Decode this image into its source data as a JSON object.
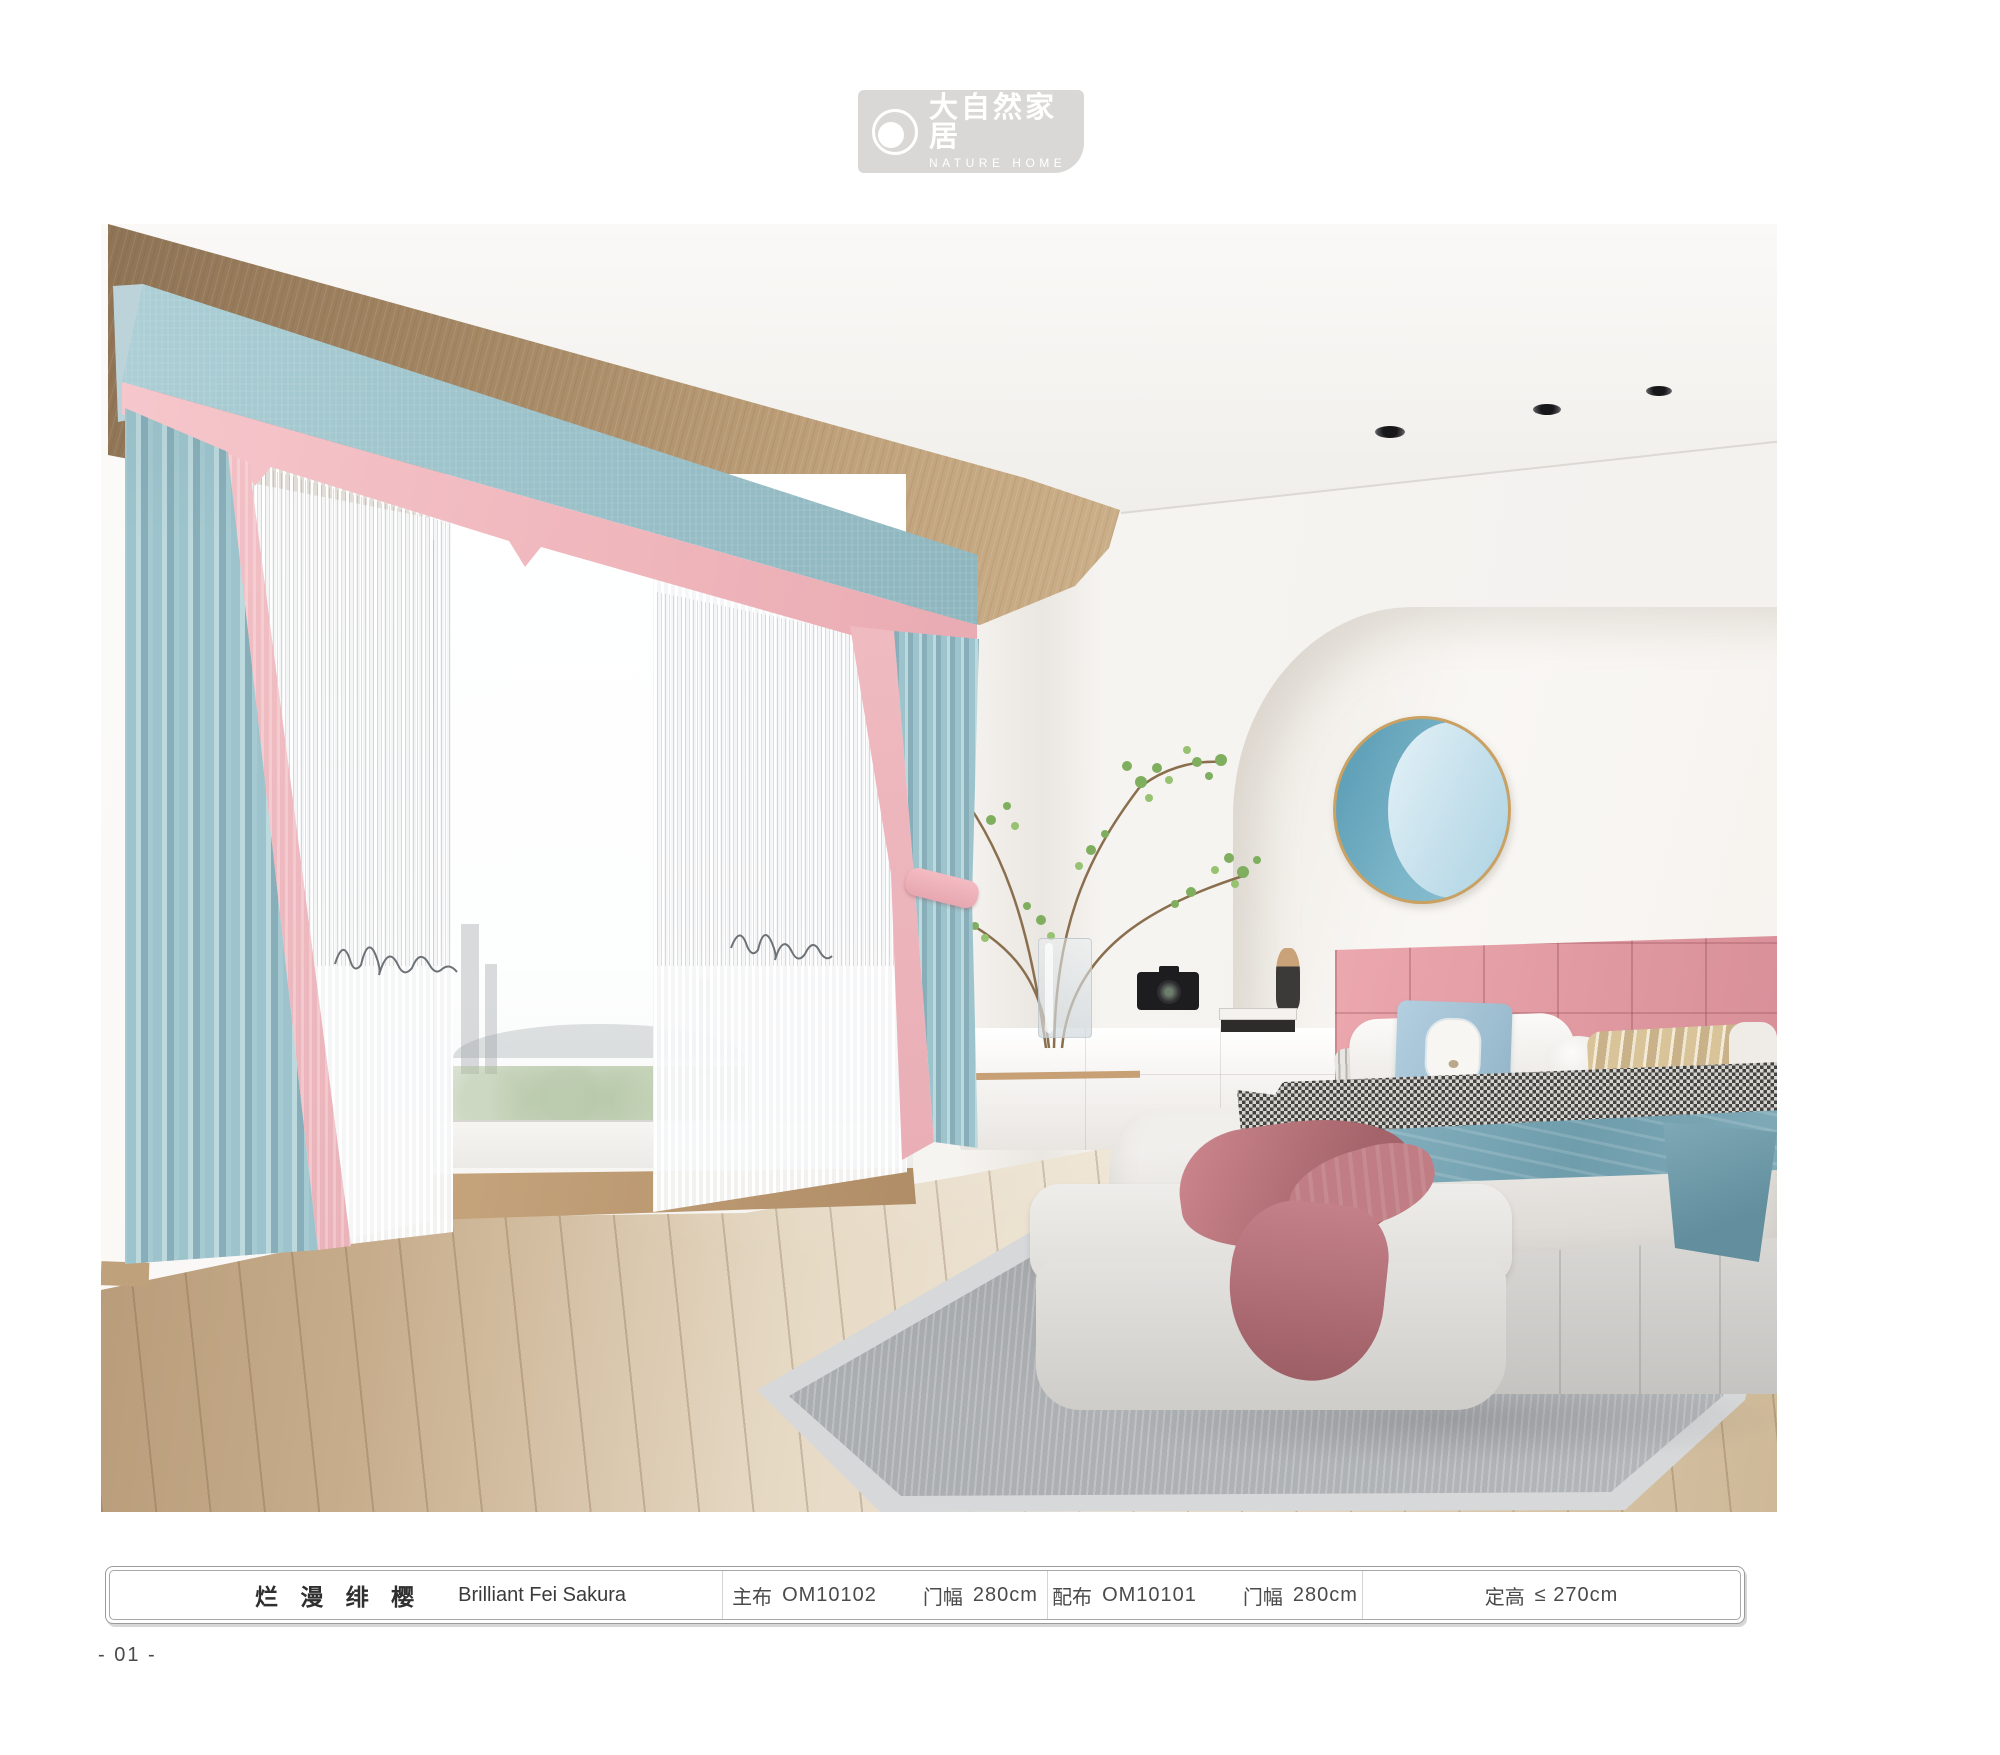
{
  "brand": {
    "name_cn": "大自然家居",
    "name_en": "NATURE HOME"
  },
  "product": {
    "name_cn": "烂 漫 绯 樱",
    "name_en": "Brilliant Fei Sakura",
    "main_fabric": {
      "label": "主布",
      "code": "OM10102",
      "width_label": "门幅",
      "width": "280cm"
    },
    "companion_fabric": {
      "label": "配布",
      "code": "OM10101",
      "width_label": "门幅",
      "width": "280cm"
    },
    "fixed_height": {
      "label": "定高",
      "value": "≤ 270cm"
    }
  },
  "page_number": "- 01 -",
  "colors": {
    "logo_badge_bg": "#d9d8d6",
    "curtain_blue": "#9cc2ca",
    "curtain_pink": "#f2bcc1",
    "valance_blue": "#a9ccd3",
    "wood_beam": "#a68a68",
    "headboard_pink": "#e7a2a8",
    "blanket_blue": "#7fa9b7",
    "rug_gray": "#b3b6b9",
    "wall_art_rim_gold": "#c9a163",
    "wall_art_blue_deep": "#5f9fb6",
    "wall_art_blue_light": "#cfe6f0",
    "floor_wood": "#c7ad8c"
  }
}
